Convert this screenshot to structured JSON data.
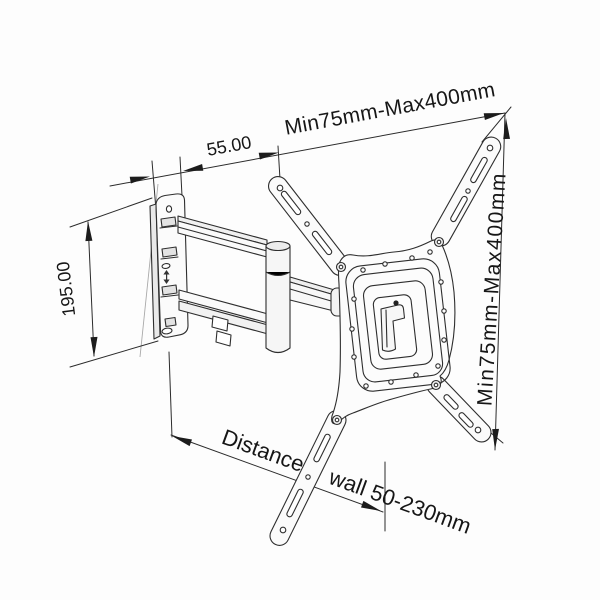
{
  "colors": {
    "background": "#fdfdfd",
    "line": "#2b2b2b",
    "text": "#161616"
  },
  "labels": {
    "top_width": "Min75mm-Max400mm",
    "right_height": "Min75mm-Max400mm",
    "arm_offset": "55.00",
    "wall_plate_height": "195.00",
    "distance_word": "Distance",
    "distance_value": "wall 50-230mm"
  }
}
